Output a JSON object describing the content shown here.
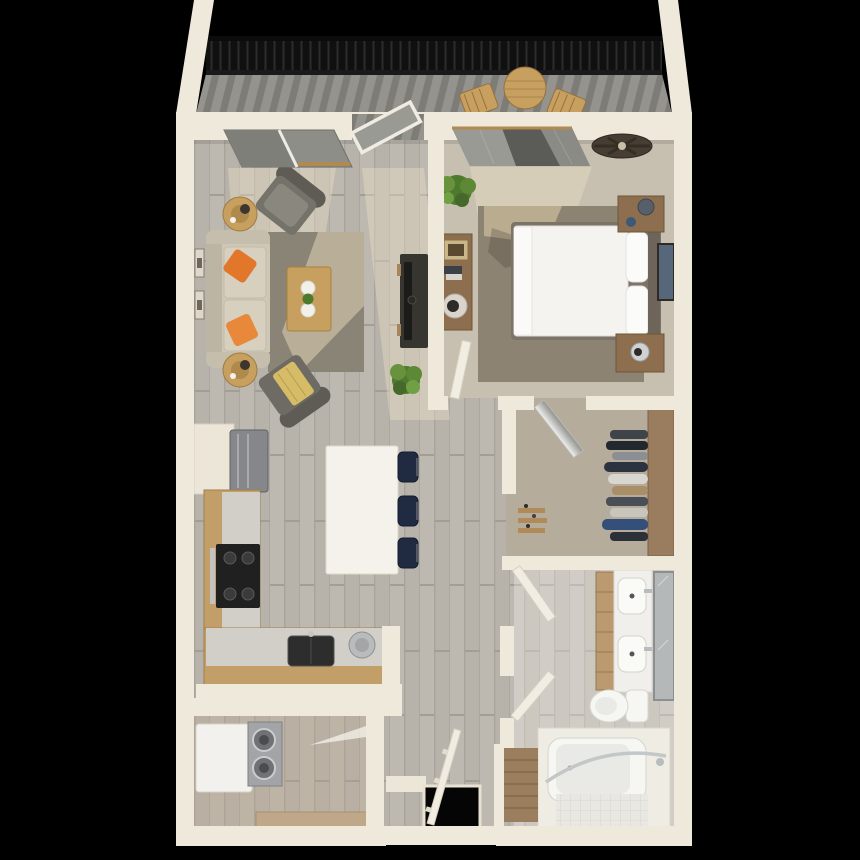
{
  "meta": {
    "description": "3D top-down rendering of a one-bedroom, one-bathroom apartment floor plan with balcony on a black background",
    "view": "top-down 3D dollhouse render",
    "visible_text": []
  },
  "palette": {
    "background": "#000000",
    "wall": "#efe9dc",
    "wall_edge": "#d3cbba",
    "wood_floor": "#b7b2aa",
    "wood_plank_line": "#a8a39b",
    "deck": "#95938d",
    "deck_stripe": "#7e7c76",
    "railing": "#101010",
    "glass": "#8e8e89",
    "glass_dark": "#5b5b57",
    "carpet_bedroom": "#c7bfb0",
    "carpet_closet": "#b6ac9b",
    "rug_living": "#8a8476",
    "rug_bedroom": "#8d8373",
    "sofa": "#cfc7b5",
    "pillow_orange": "#e2762a",
    "armchair": "#75726a",
    "throw_gold": "#d6bc67",
    "wood_furniture": "#8d6f50",
    "wood_light": "#c7a05f",
    "tv_console": "#36352f",
    "plant": "#4d7a2d",
    "island": "#f5f2eb",
    "stool_navy": "#202a40",
    "cabinet_oak": "#c29e68",
    "countertop": "#d2cfc9",
    "stove": "#202020",
    "appliance_steel": "#85878b",
    "washer_steel": "#a2a4a7",
    "bed_linen": "#f4f3f0",
    "headboard": "#6e655a",
    "shelf_brown": "#9a7c5e",
    "vanity_wood": "#bb9a70",
    "mirror": "#b4b8b9",
    "porcelain": "#f6f6f3",
    "tile": "#e9e7e1",
    "stairs": "#9a7e5d",
    "light_shaft": "rgba(240,229,200,0.38)",
    "shadow": "rgba(60,52,40,0.25)"
  },
  "rooms": [
    {
      "id": "balcony",
      "name": "balcony",
      "furniture": [
        "black-slat-railing",
        "round-outdoor-table",
        "outdoor-chair",
        "outdoor-chair",
        "glass-balcony-door"
      ]
    },
    {
      "id": "living-room",
      "name": "living room",
      "furniture": [
        "beige-sofa",
        "orange-throw-pillows",
        "round-side-table-with-lamp",
        "round-side-table-with-lamp",
        "gray-armchair",
        "gray-armchair-with-gold-throw",
        "area-rug",
        "wood-coffee-table",
        "tv-console",
        "flat-tv",
        "wall-art-frames",
        "floor-plant",
        "front-window"
      ]
    },
    {
      "id": "bedroom",
      "name": "bedroom",
      "furniture": [
        "queen-bed-white-duvet",
        "pillows",
        "headboard",
        "nightstand",
        "nightstand",
        "dresser",
        "ceiling-fan",
        "wall-art",
        "plant",
        "area-rug",
        "curtained-window",
        "door"
      ]
    },
    {
      "id": "walk-in-closet",
      "name": "walk-in closet",
      "furniture": [
        "hanging-clothes",
        "closet-shelf",
        "shoe-shelves",
        "door"
      ]
    },
    {
      "id": "kitchen",
      "name": "kitchen",
      "furniture": [
        "refrigerator",
        "upper-cabinet-run",
        "range-stove",
        "counter-sink",
        "round-prep-sink",
        "white-island",
        "bar-stool",
        "bar-stool",
        "bar-stool"
      ]
    },
    {
      "id": "bathroom",
      "name": "bathroom",
      "furniture": [
        "double-vanity",
        "sink",
        "sink",
        "wall-mirror",
        "toilet",
        "tub-shower-with-curved-rod",
        "door",
        "door"
      ]
    },
    {
      "id": "laundry",
      "name": "laundry room",
      "furniture": [
        "washer-dryer-unit",
        "door"
      ]
    },
    {
      "id": "entry",
      "name": "entry / stairs",
      "furniture": [
        "stairwell-opening",
        "stair-railing",
        "carpeted-stairs"
      ]
    }
  ]
}
